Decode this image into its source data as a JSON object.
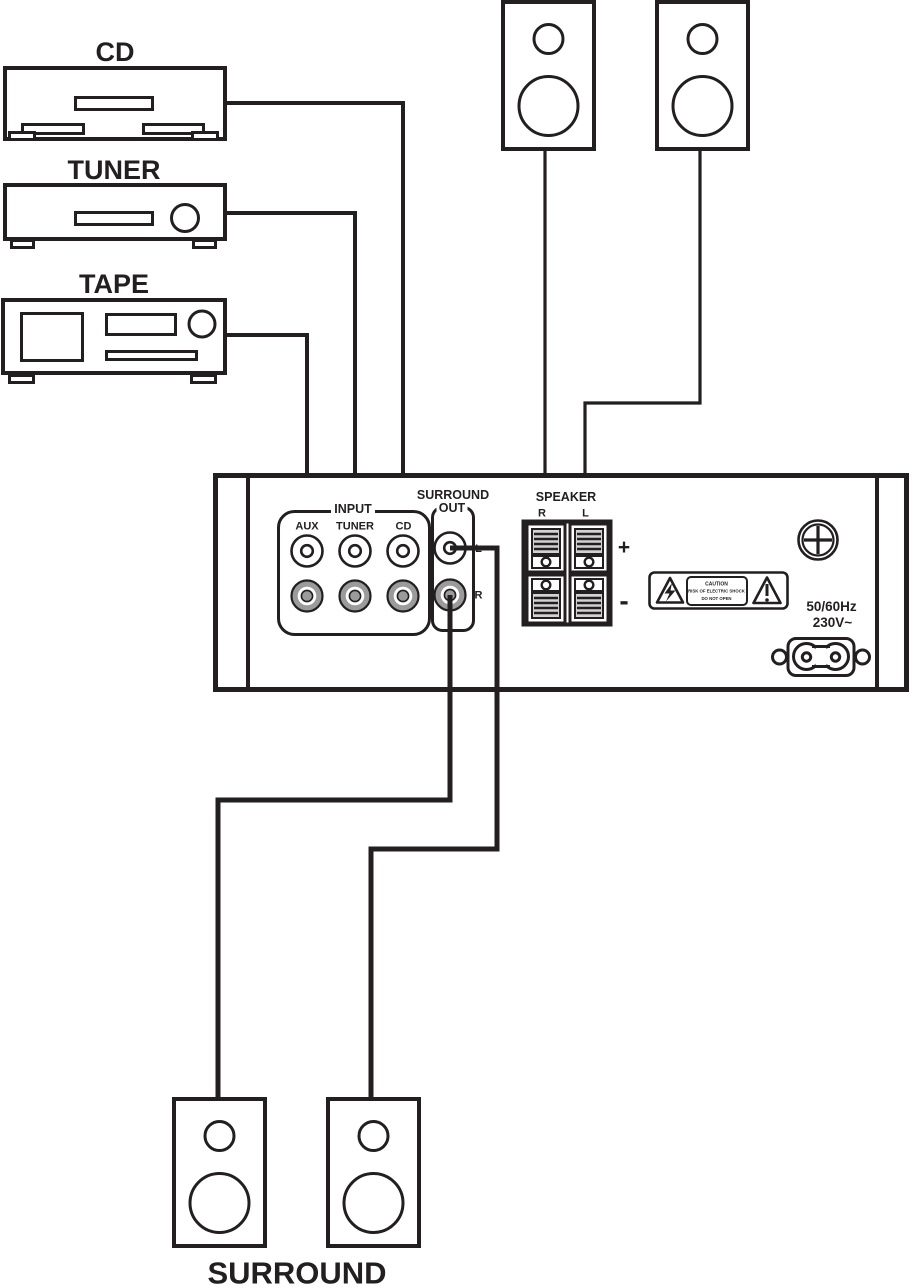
{
  "devices": {
    "cd": "CD",
    "tuner": "TUNER",
    "tape": "TAPE"
  },
  "amplifier": {
    "input": {
      "label": "INPUT",
      "jacks": [
        "AUX",
        "TUNER",
        "CD"
      ]
    },
    "surround_out": {
      "label_line1": "SURROUND",
      "label_line2": "OUT",
      "jack_l": "L",
      "jack_r": "R"
    },
    "speaker": {
      "label": "SPEAKER",
      "right": "R",
      "left": "L",
      "plus": "+",
      "minus": "-"
    },
    "caution": {
      "line1": "CAUTION",
      "line2": "RISK OF ELECTRIC SHOCK",
      "line3": "DO NOT OPEN"
    },
    "power": {
      "frequency": "50/60Hz",
      "voltage": "230V~"
    }
  },
  "surround_speakers": {
    "label": "SURROUND"
  },
  "colors": {
    "ink": "#231f20",
    "jack_gray": "#9b9b9b",
    "stripe_bg": "#d2d2d2"
  }
}
